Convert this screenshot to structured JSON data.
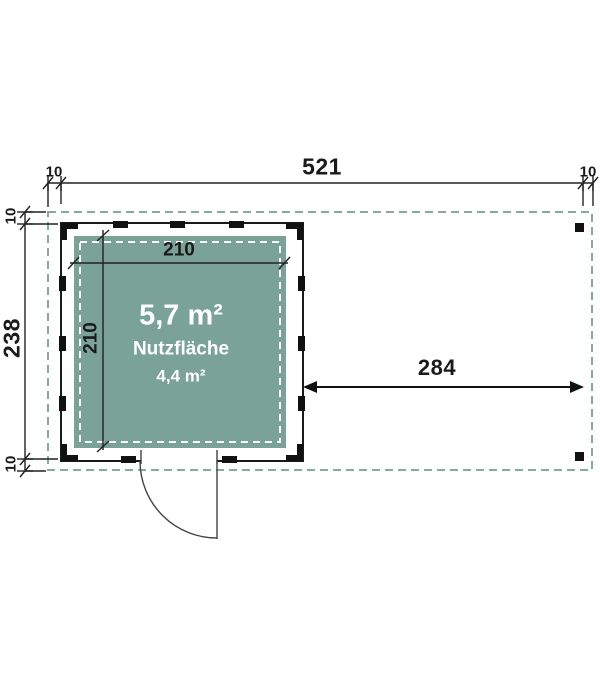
{
  "plan": {
    "dimensions": {
      "top": {
        "left_overhang": "10",
        "total_width": "521",
        "right_overhang": "10"
      },
      "left": {
        "top_overhang": "10",
        "total_depth": "238",
        "bottom_overhang": "10"
      },
      "interior": {
        "width": "210",
        "depth": "210"
      },
      "canopy_width": "284"
    },
    "room": {
      "gross_area": "5,7 m²",
      "usable_label": "Nutzfläche",
      "usable_area": "4,4 m²"
    },
    "colors": {
      "room_fill": "#7aa296",
      "roof_outline_dash": "#85aba0",
      "line": "#1f1f1f",
      "room_text": "#ffffff"
    }
  }
}
